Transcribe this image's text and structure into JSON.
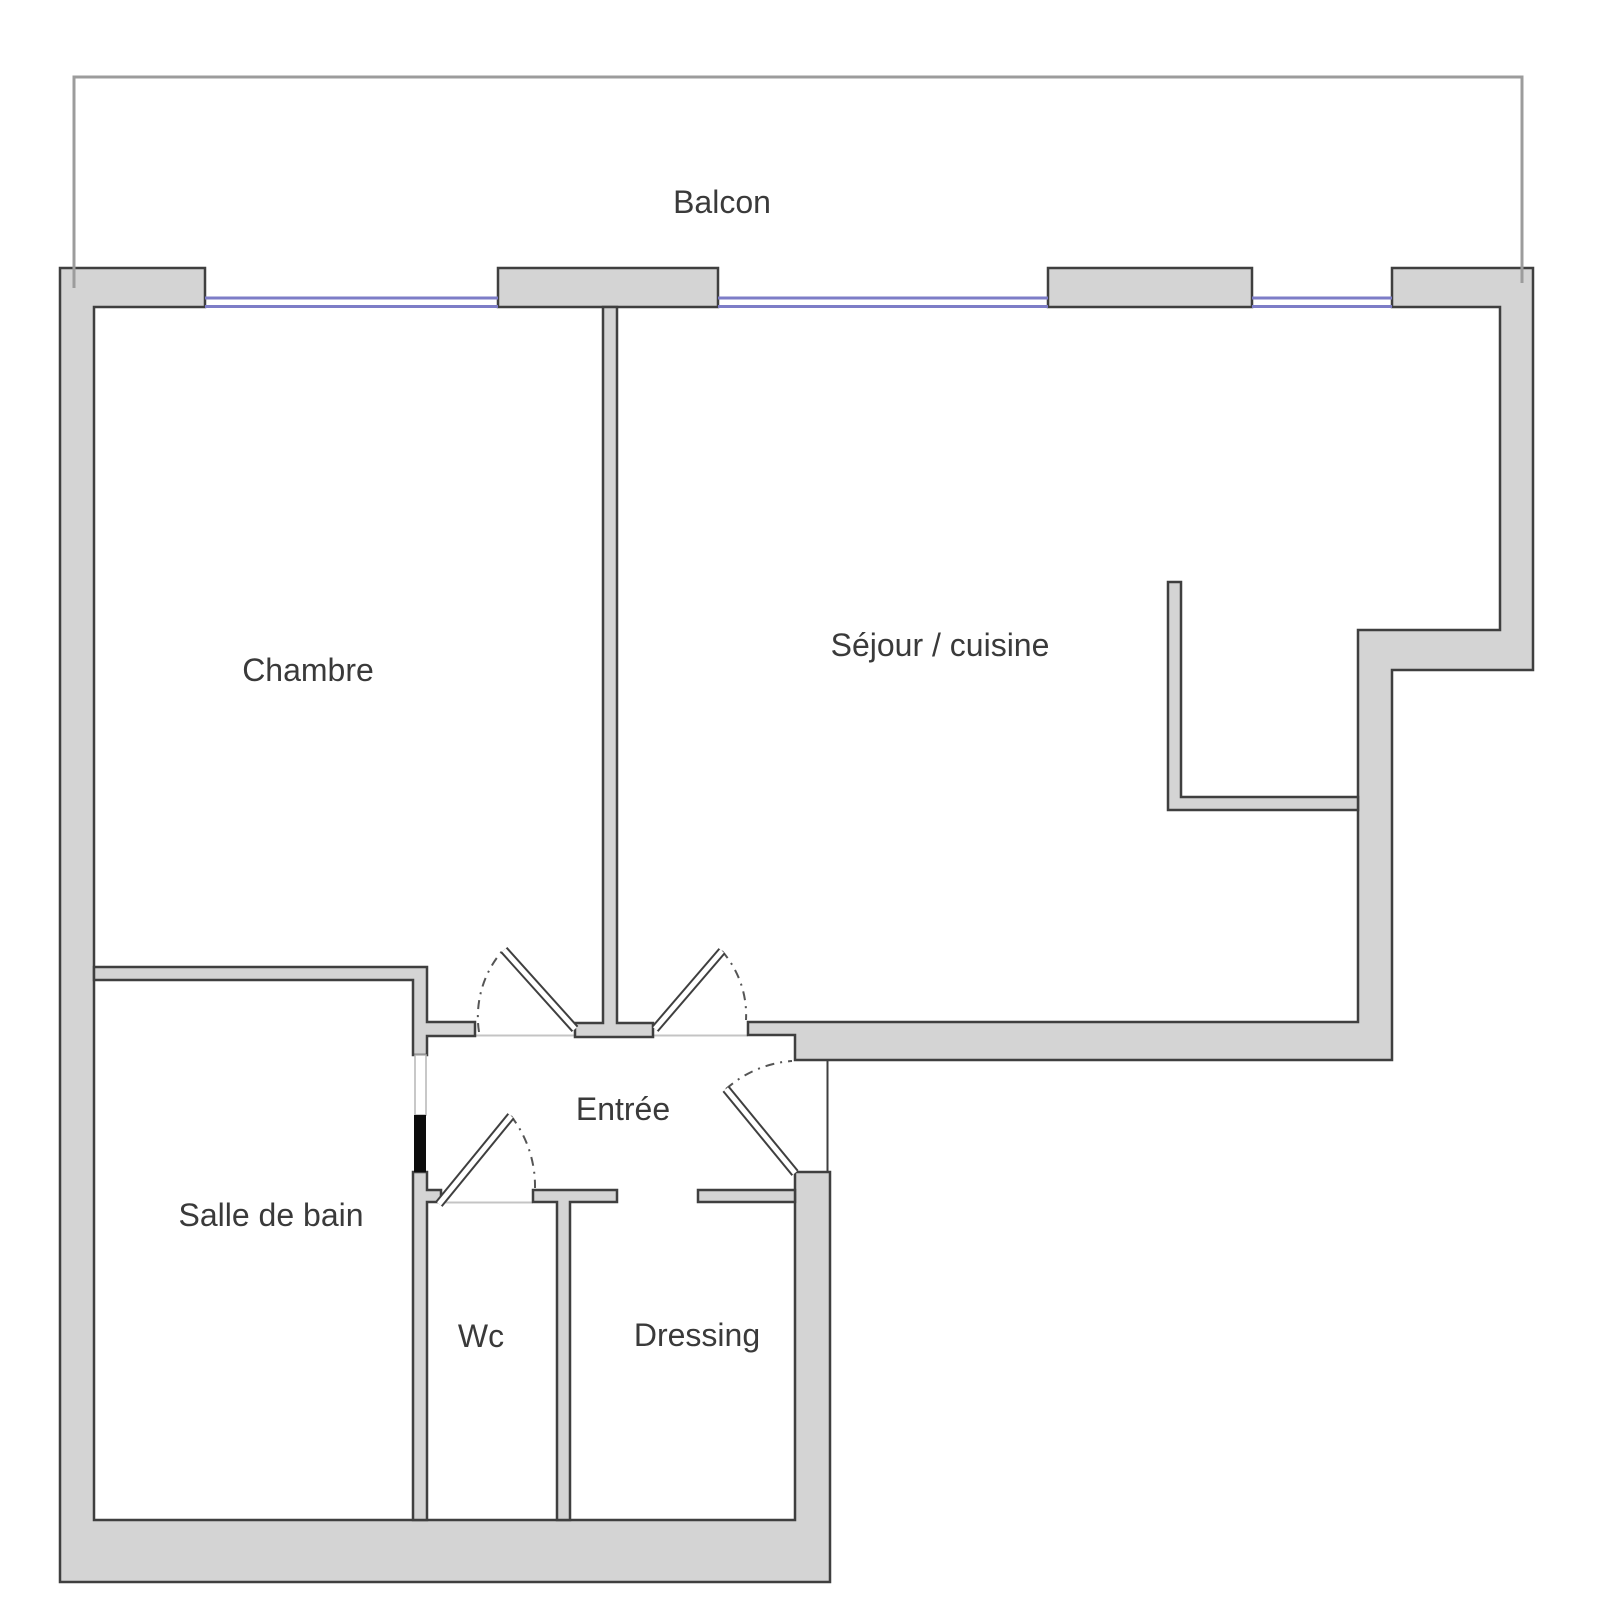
{
  "plan": {
    "labels": {
      "balcon": "Balcon",
      "chambre": "Chambre",
      "sejour": "Séjour / cuisine",
      "entree": "Entrée",
      "salle_de_bain": "Salle de bain",
      "wc": "Wc",
      "dressing": "Dressing"
    },
    "colors": {
      "wall_fill": "#d4d4d4",
      "wall_stroke": "#3f3f3f",
      "window_blue": "#7d7dc7",
      "balcony_line": "#9c9c9c",
      "text_color": "#3a3a3a",
      "door_black": "#0c0c0c",
      "floor_line": "#c4c4c4",
      "background": "#ffffff"
    }
  }
}
